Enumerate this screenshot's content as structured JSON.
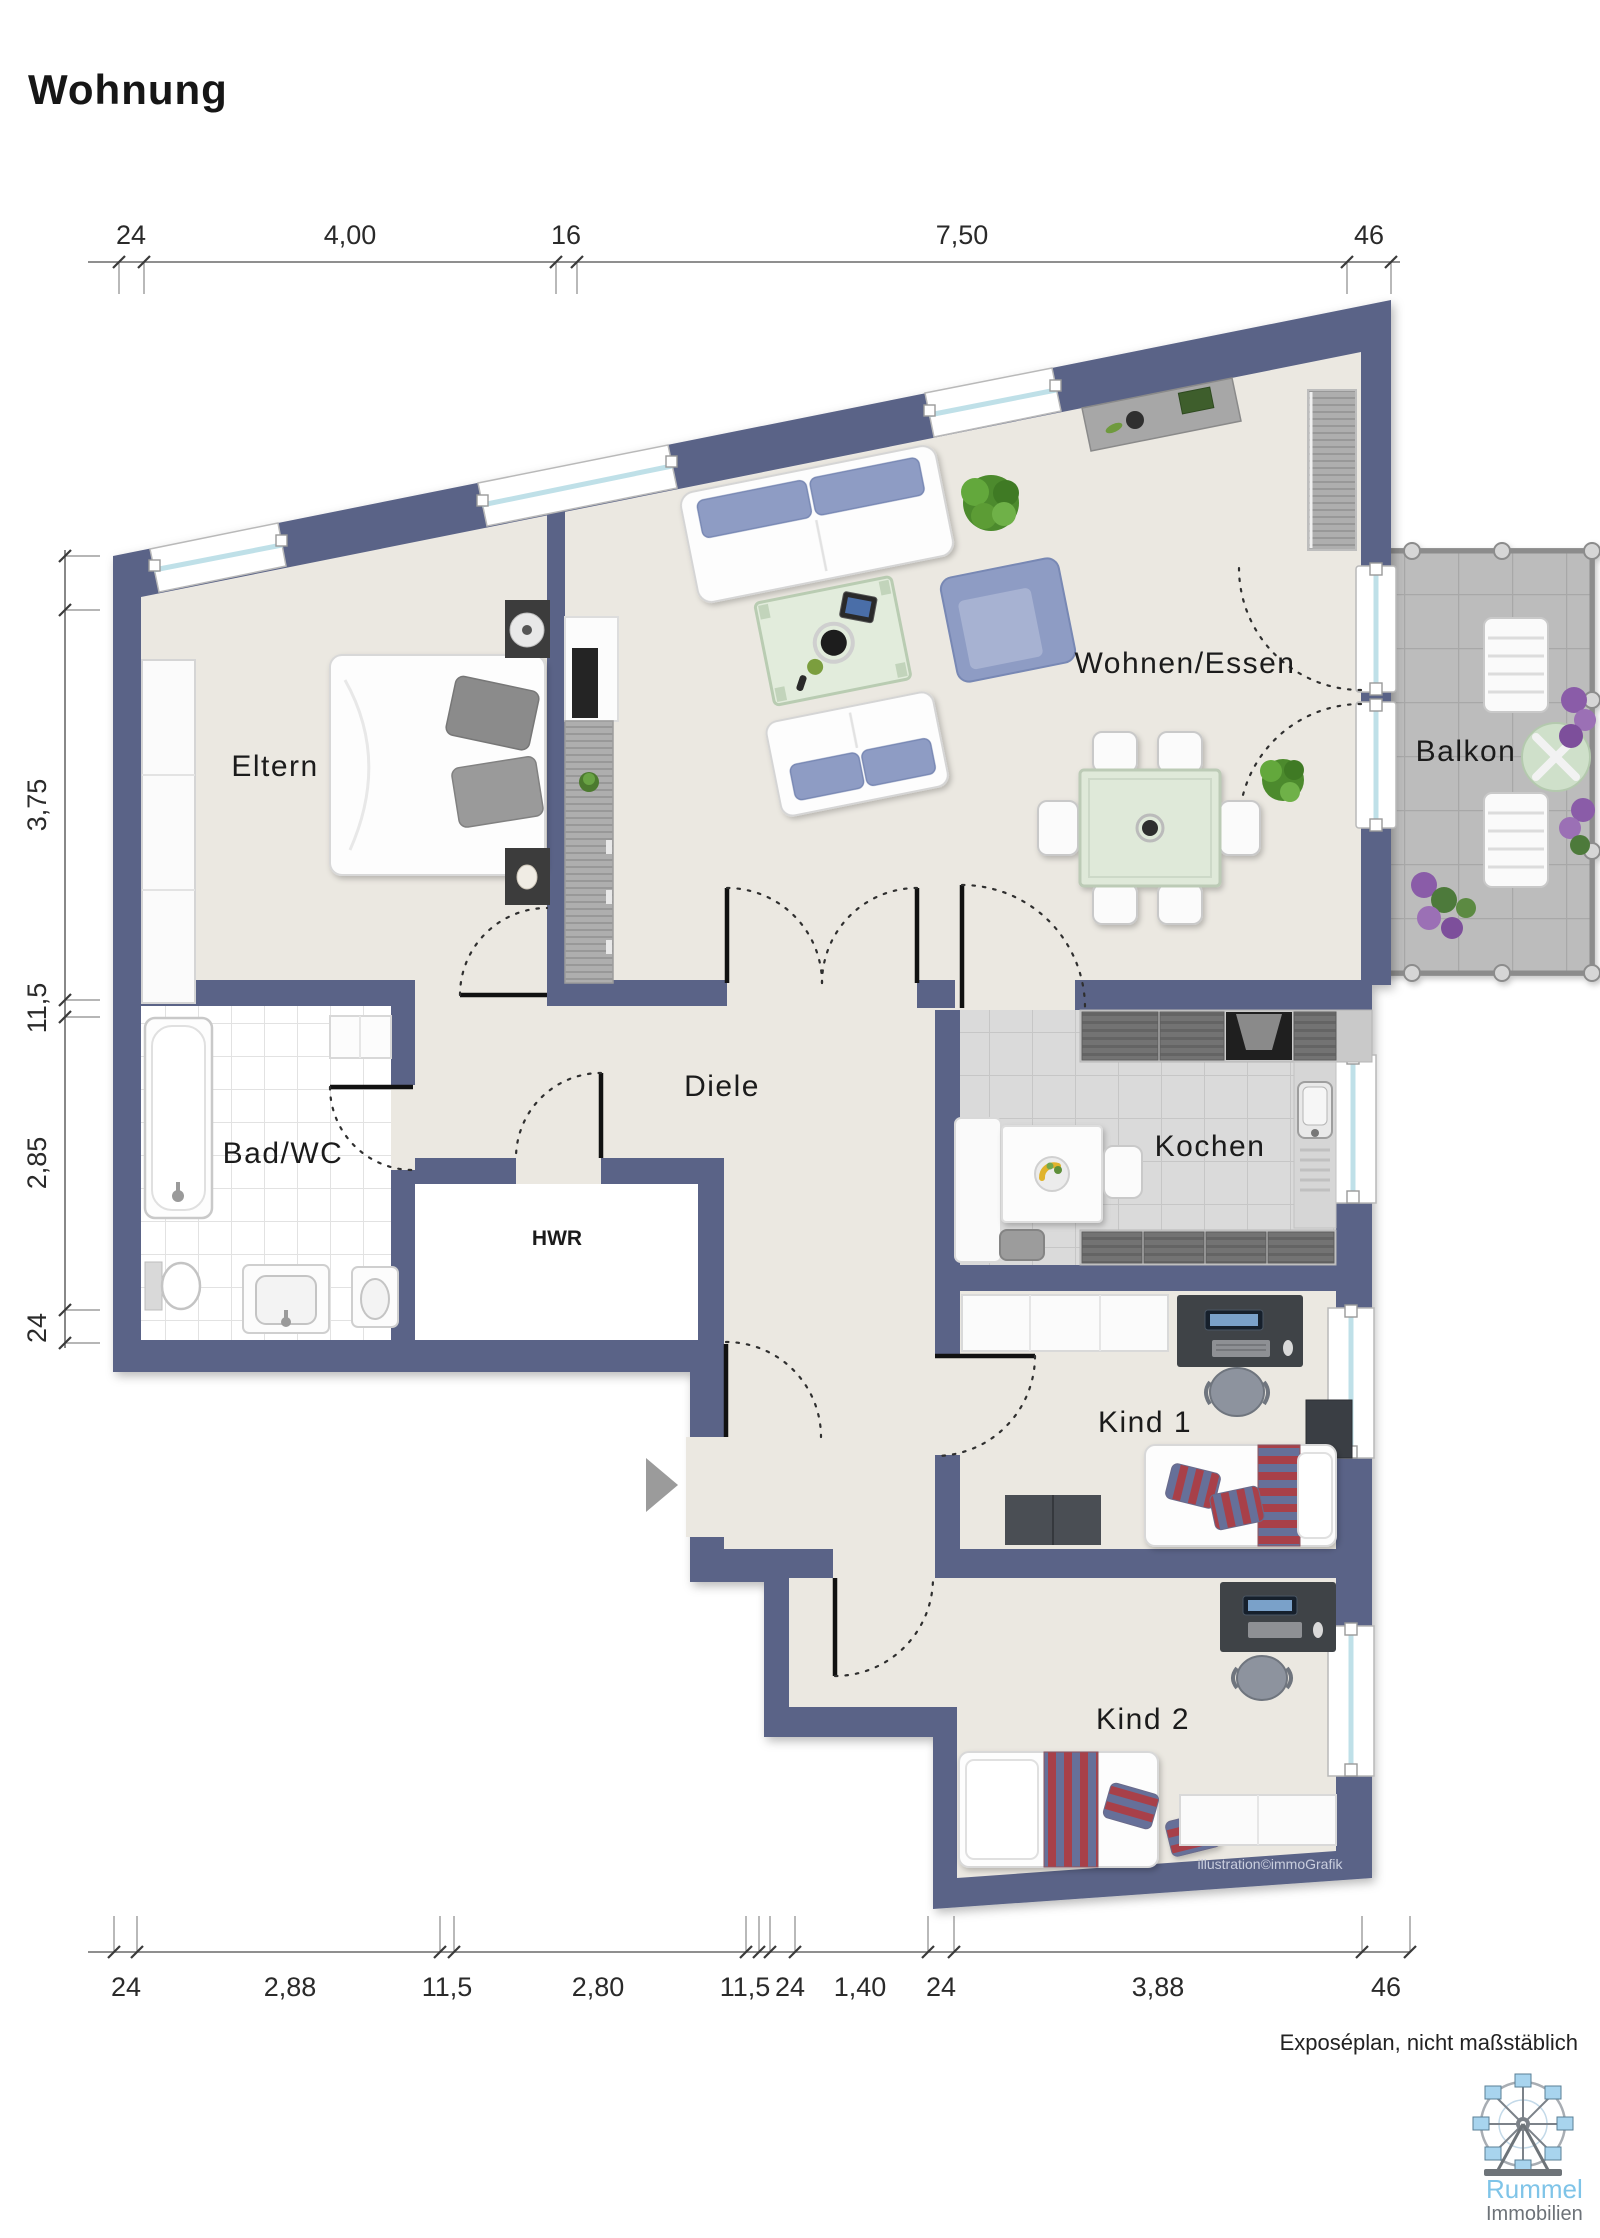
{
  "title": "Wohnung",
  "rooms": {
    "eltern": "Eltern",
    "wohnen": "Wohnen/Essen",
    "balkon": "Balkon",
    "bad": "Bad/WC",
    "hwr": "HWR",
    "diele": "Diele",
    "kochen": "Kochen",
    "kind1": "Kind 1",
    "kind2": "Kind 2"
  },
  "dims": {
    "top": [
      "24",
      "4,00",
      "16",
      "7,50",
      "46"
    ],
    "left": [
      "3,75",
      "11,5",
      "2,85",
      "24"
    ],
    "bottom": [
      "24",
      "2,88",
      "11,5",
      "2,80",
      "11,5",
      "24",
      "1,40",
      "24",
      "3,88",
      "46"
    ]
  },
  "footer": {
    "note": "Exposéplan, nicht maßstäblich",
    "credit": "illustration©immoGrafik"
  },
  "logo": {
    "name": "Rummel",
    "type": "Immobilien"
  },
  "colors": {
    "wall": "#5a6387",
    "floor": "#ebe8e1",
    "sofa_accent": "#8e9cc4",
    "balcony_tile": "#bcbcbc",
    "logo_blue": "#7fc4e8"
  }
}
